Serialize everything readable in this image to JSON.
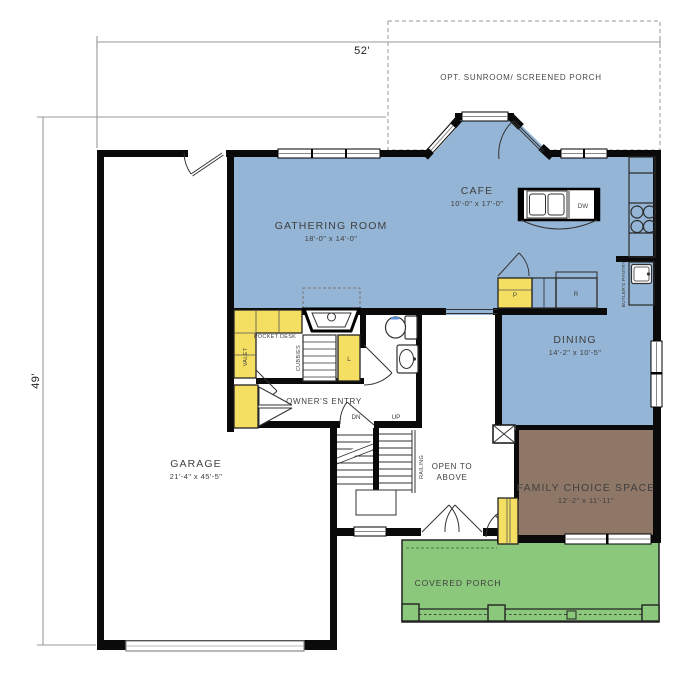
{
  "plan": {
    "dimensions": {
      "width": "52'",
      "depth": "49'"
    },
    "rooms": {
      "sunroom": {
        "name": "OPT. SUNROOM/ SCREENED PORCH"
      },
      "cafe": {
        "name": "CAFE",
        "size": "10'-0\" x 17'-0\""
      },
      "gathering": {
        "name": "GATHERING ROOM",
        "size": "18'-0\" x 14'-0\""
      },
      "dining": {
        "name": "DINING",
        "size": "14'-2\" x 10'-5\""
      },
      "family": {
        "name": "FAMILY CHOICE SPACE",
        "size": "12'-2\" x 11'-11\""
      },
      "garage": {
        "name": "GARAGE",
        "size": "21'-4\" x 45'-5\""
      },
      "porch": {
        "name": "COVERED PORCH"
      },
      "owners_entry": {
        "name": "OWNER'S ENTRY"
      },
      "open_to_above": {
        "line1": "OPEN TO",
        "line2": "ABOVE"
      }
    },
    "annotations": {
      "pocket_desk": "POCKET DESK",
      "valet": "VALET",
      "cubbies": "CUBBIES",
      "linen_closet": "L",
      "pantry": "P",
      "refrigerator": "R",
      "dishwasher": "DW",
      "stairs_down": "DN",
      "stairs_up": "UP",
      "railing": "RAILING",
      "butlers_pantry": "BUTLER'S PANTRY"
    },
    "colors": {
      "living_area": "#94b5d5",
      "cabinet_yellow": "#f5df63",
      "family_brown": "#8e7767",
      "porch_green": "#8cc87c",
      "wall": "#0a0a0a",
      "dimension_line": "#9a9a9a",
      "label_text": "#3f3f3f"
    }
  }
}
